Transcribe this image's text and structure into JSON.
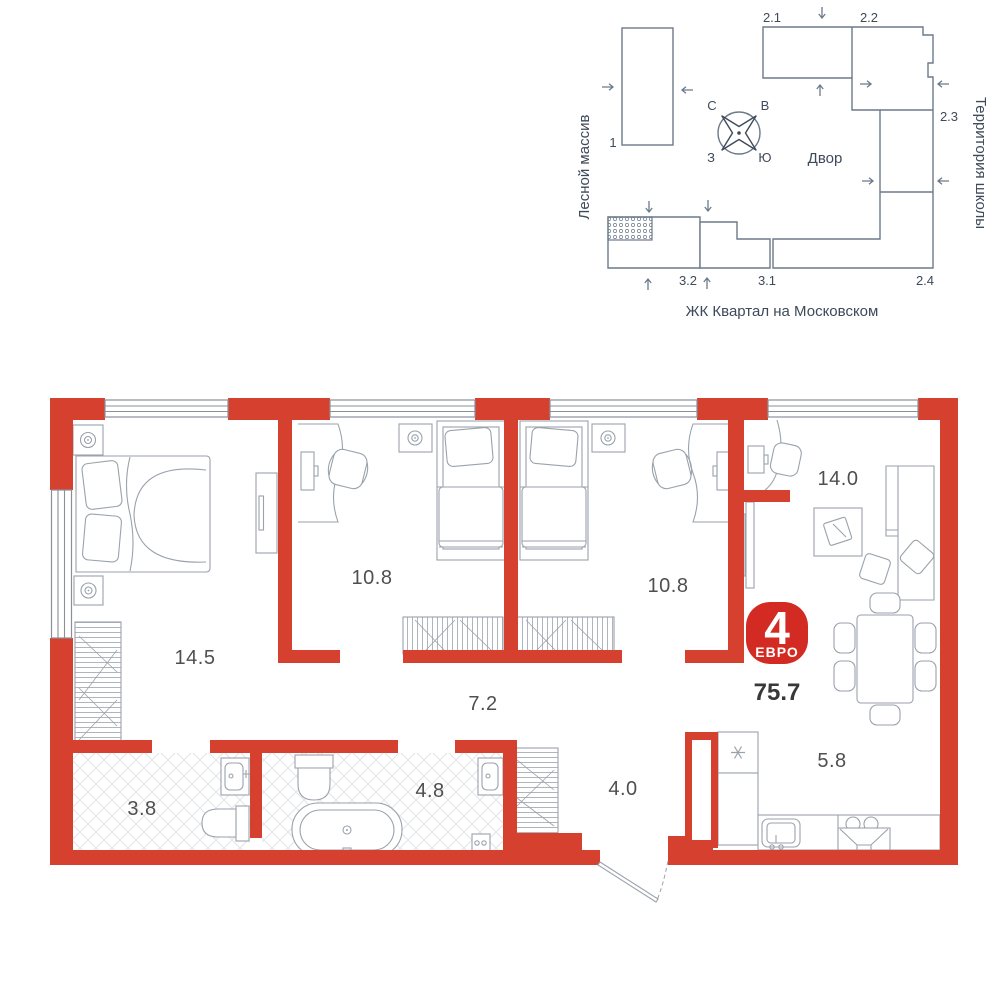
{
  "site_plan": {
    "left_area_label": "Лесной массив",
    "right_area_label": "Территория школы",
    "courtyard_label": "Двор",
    "caption": "ЖК Квартал на Московском",
    "compass": {
      "north": "С",
      "east": "В",
      "west": "З",
      "south": "Ю"
    },
    "building_labels": {
      "b1": "1",
      "b21": "2.1",
      "b22": "2.2",
      "b23": "2.3",
      "b24": "2.4",
      "b31": "3.1",
      "b32": "3.2"
    }
  },
  "floor_plan": {
    "rooms": [
      {
        "name": "bedroom",
        "area": "14.5"
      },
      {
        "name": "bedroom-2",
        "area": "10.8"
      },
      {
        "name": "bedroom-3",
        "area": "10.8"
      },
      {
        "name": "living-room",
        "area": "14.0"
      },
      {
        "name": "corridor",
        "area": "7.2"
      },
      {
        "name": "bathroom",
        "area": "3.8"
      },
      {
        "name": "bathroom-2",
        "area": "4.8"
      },
      {
        "name": "hallway",
        "area": "4.0"
      },
      {
        "name": "kitchen",
        "area": "5.8"
      }
    ],
    "badge": {
      "rooms_count": "4",
      "layout_type": "ЕВРО",
      "total_area": "75.7"
    }
  },
  "colors": {
    "wall_red": "#d6402f",
    "badge_red": "#d32b23",
    "furniture_line": "#9aa2ac",
    "site_line": "#6b7a8a",
    "site_text": "#3e4a5a",
    "area_text": "#4f4f4f",
    "tile_line": "#e2e4e7"
  }
}
